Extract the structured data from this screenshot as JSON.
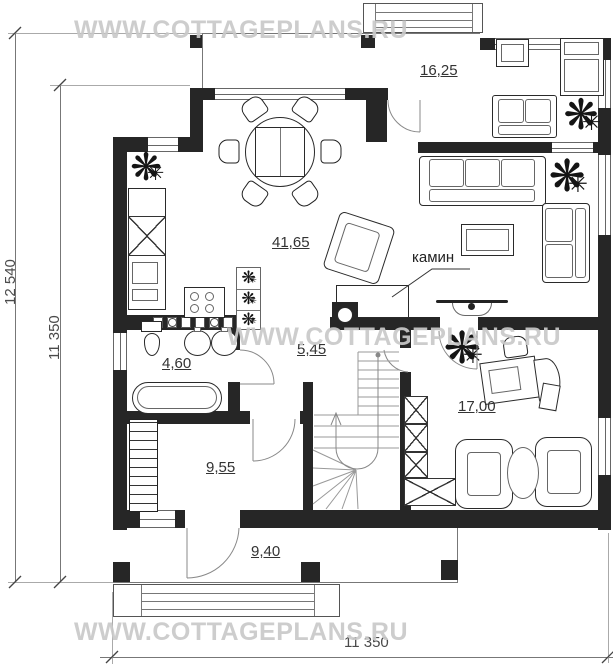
{
  "watermark": {
    "text": "WWW.COTTAGEPLANS.RU"
  },
  "dimensions": {
    "left_outer": "12 540",
    "left_inner": "11 350",
    "bottom": "11 350"
  },
  "rooms": {
    "bedroom": {
      "area": "16,25"
    },
    "living_kitchen": {
      "area": "41,65"
    },
    "hall": {
      "area": "5,45"
    },
    "bathroom": {
      "area": "4,60"
    },
    "utility": {
      "area": "9,55"
    },
    "study": {
      "area": "17,00"
    },
    "porch": {
      "area": "9,40"
    }
  },
  "annotations": {
    "fireplace": "камин"
  },
  "colors": {
    "wall": "#262626",
    "line": "#777777",
    "watermark": "#c9c9c9",
    "text": "#333333"
  }
}
